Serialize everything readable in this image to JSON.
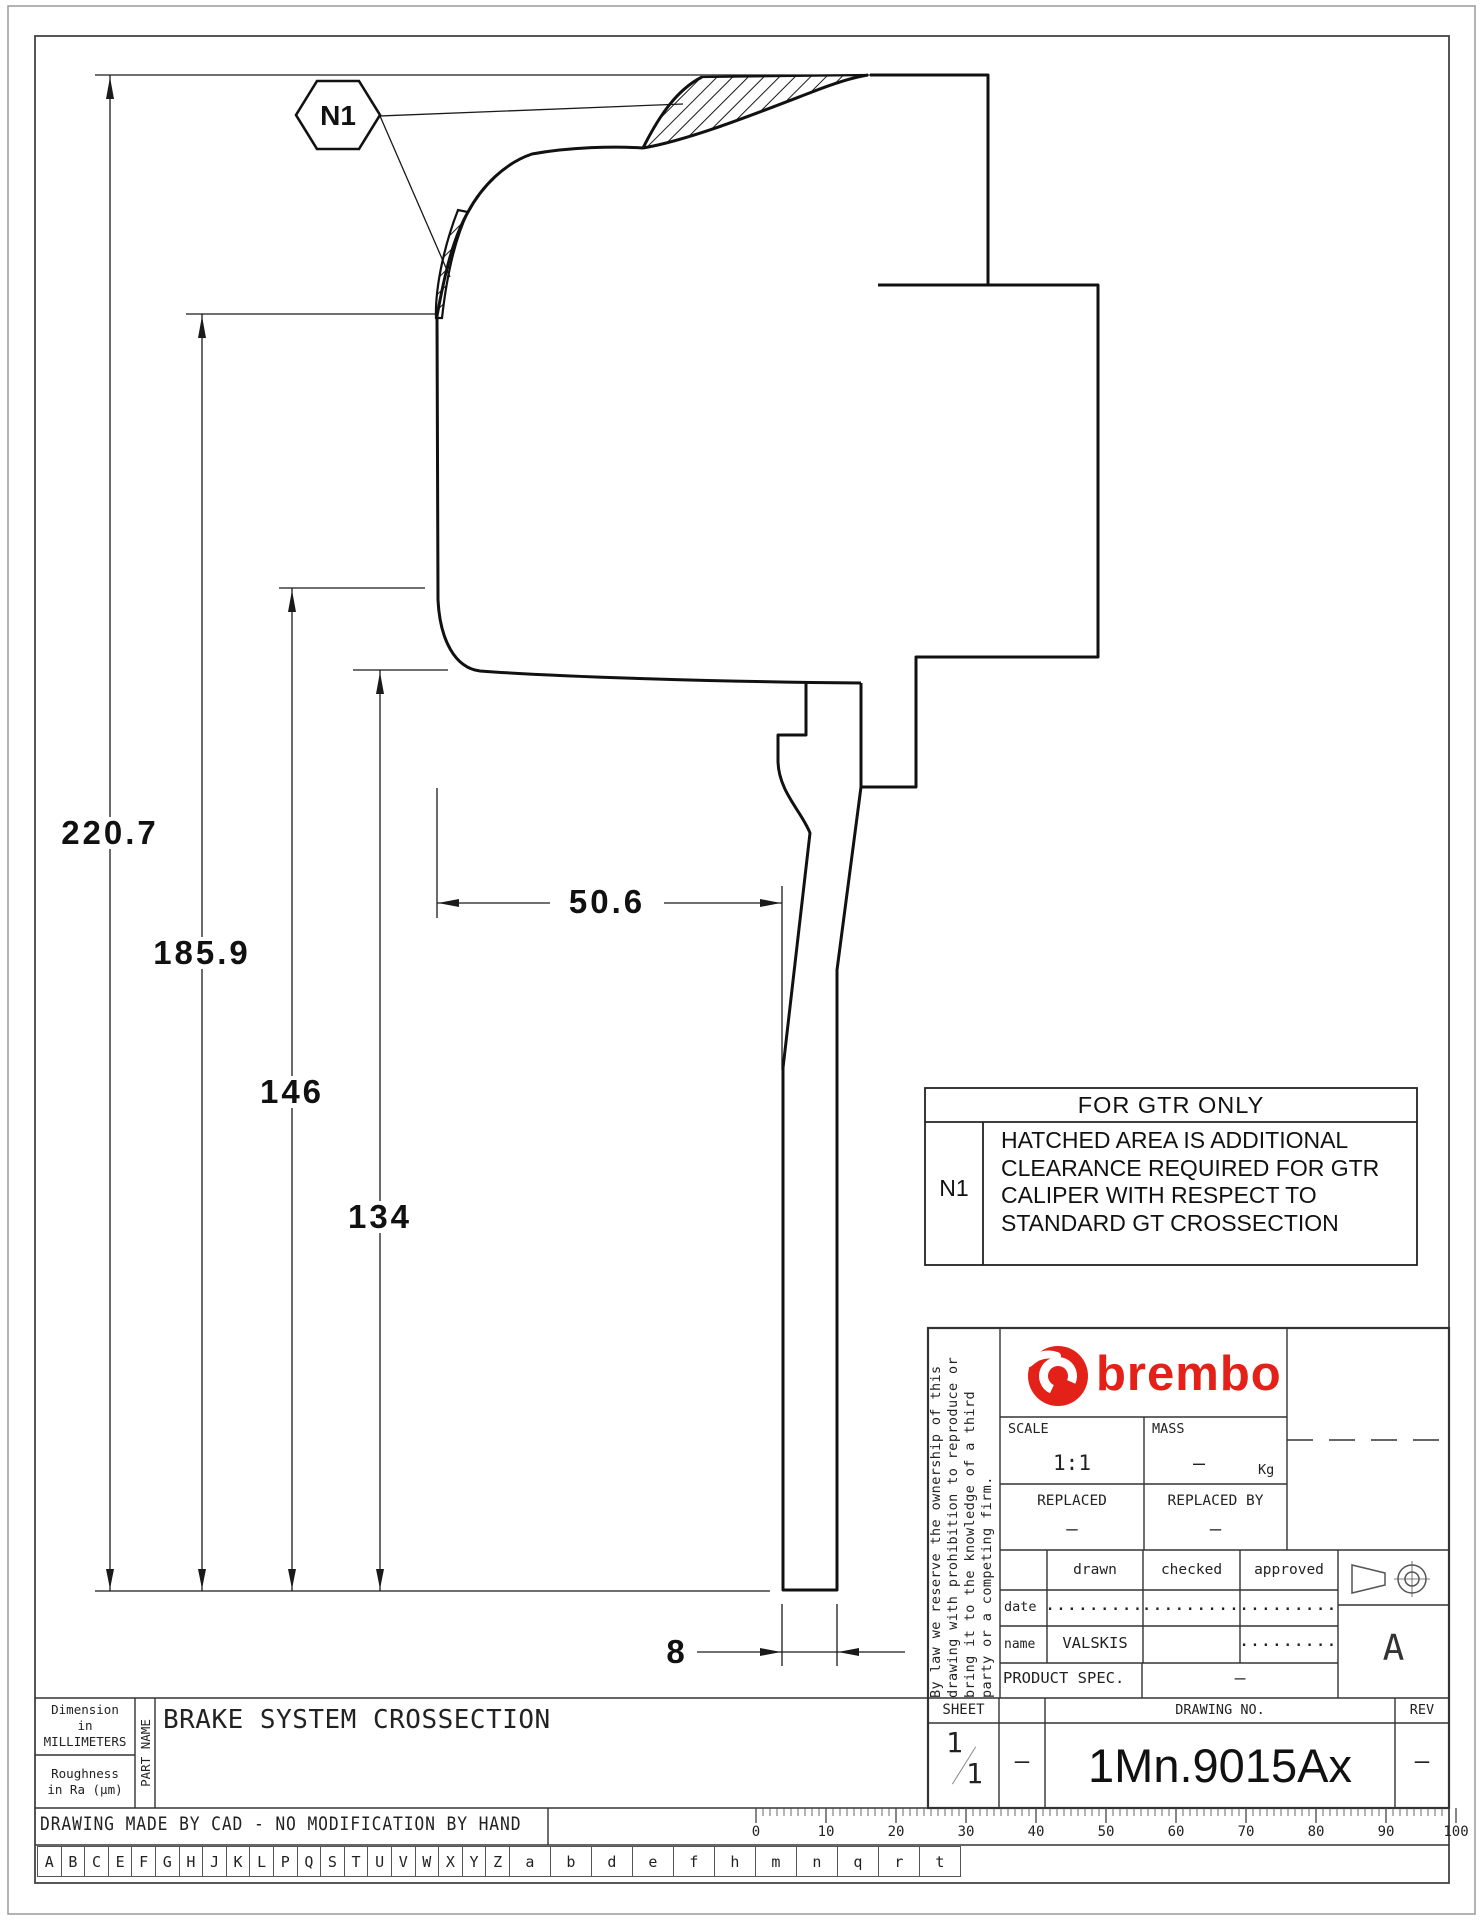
{
  "colors": {
    "brand_red": "#e32119",
    "line": "#1a1a1a"
  },
  "callout": {
    "label": "N1"
  },
  "dims": {
    "d220": "220.7",
    "d185": "185.9",
    "d146": "146",
    "d134": "134",
    "d50": "50.6",
    "d8": "8"
  },
  "note_table": {
    "header": "FOR GTR ONLY",
    "ref": "N1",
    "line1": "HATCHED AREA IS ADDITIONAL",
    "line2": "CLEARANCE REQUIRED FOR GTR",
    "line3": "CALIPER WITH RESPECT TO",
    "line4": "STANDARD GT CROSSECTION"
  },
  "title_block": {
    "legal_line1": "By law we reserve the ownership of this",
    "legal_line2": "drawing with prohibition to reproduce or",
    "legal_line3": "bring it to the knowledge of a third",
    "legal_line4": "party or a competing firm.",
    "brand": "brembo",
    "scale_label": "SCALE",
    "scale_value": "1:1",
    "mass_label": "MASS",
    "mass_value": "–",
    "mass_unit": "Kg",
    "replaced_label": "REPLACED",
    "replaced_value": "–",
    "replaced_by_label": "REPLACED BY",
    "replaced_by_value": "–",
    "col_drawn": "drawn",
    "col_checked": "checked",
    "col_approved": "approved",
    "date_label": "date",
    "date_drawn": ".........",
    "date_checked": ".........",
    "date_approved": ".........",
    "name_label": "name",
    "name_drawn": "VALSKIS",
    "name_checked": "",
    "name_approved": ".........",
    "product_spec_label": "PRODUCT SPEC.",
    "product_spec_value": "–",
    "format_letter": "A",
    "sheet_label": "SHEET",
    "sheet_num": "1",
    "sheet_den": "1",
    "sheet_aux": "–",
    "drawing_no_label": "DRAWING NO.",
    "drawing_no": "1Mn.9015Ax",
    "rev_label": "REV",
    "rev_value": "–"
  },
  "footer": {
    "dim_note_line1": "Dimension",
    "dim_note_line2": "in MILLIMETERS",
    "rough_note_line1": "Roughness",
    "rough_note_line2": "in Ra (μm)",
    "part_name_label": "PART NAME",
    "part_name": "BRAKE SYSTEM CROSSECTION",
    "cad_note": "DRAWING MADE BY CAD - NO MODIFICATION BY HAND",
    "ruler_numbers": [
      "0",
      "10",
      "20",
      "30",
      "40",
      "50",
      "60",
      "70",
      "80",
      "90",
      "100"
    ],
    "letters": [
      "A",
      "B",
      "C",
      "E",
      "F",
      "G",
      "H",
      "J",
      "K",
      "L",
      "P",
      "Q",
      "S",
      "T",
      "U",
      "V",
      "W",
      "X",
      "Y",
      "Z",
      "a",
      "b",
      "d",
      "e",
      "f",
      "h",
      "m",
      "n",
      "q",
      "r",
      "t"
    ]
  }
}
